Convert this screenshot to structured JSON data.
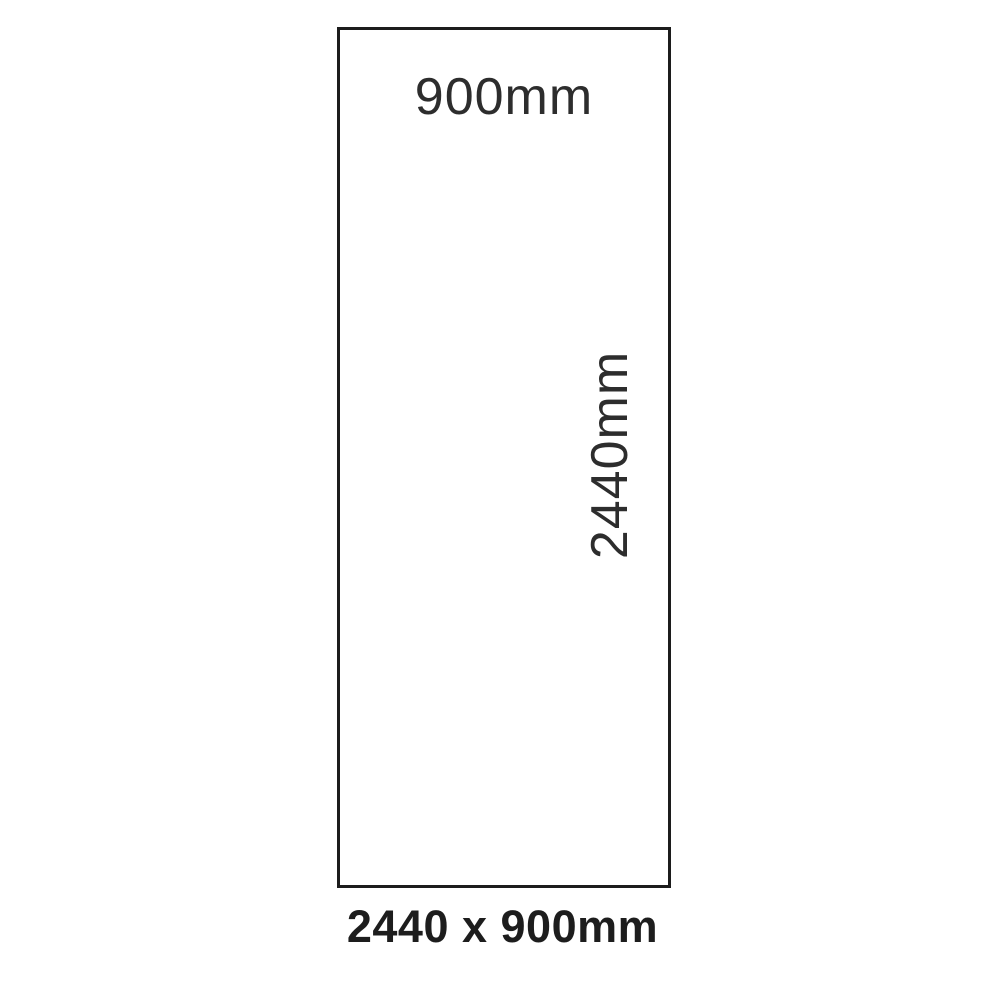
{
  "diagram": {
    "top_width_label": "900mm",
    "side_height_label": "2440mm",
    "caption": "2440 x 900mm",
    "colors": {
      "background": "#ffffff",
      "panel_fill": "#ffffff",
      "outline": "#1c1c1c",
      "dimension_text": "#2d2d2d",
      "caption_text": "#1d1d1d"
    }
  }
}
